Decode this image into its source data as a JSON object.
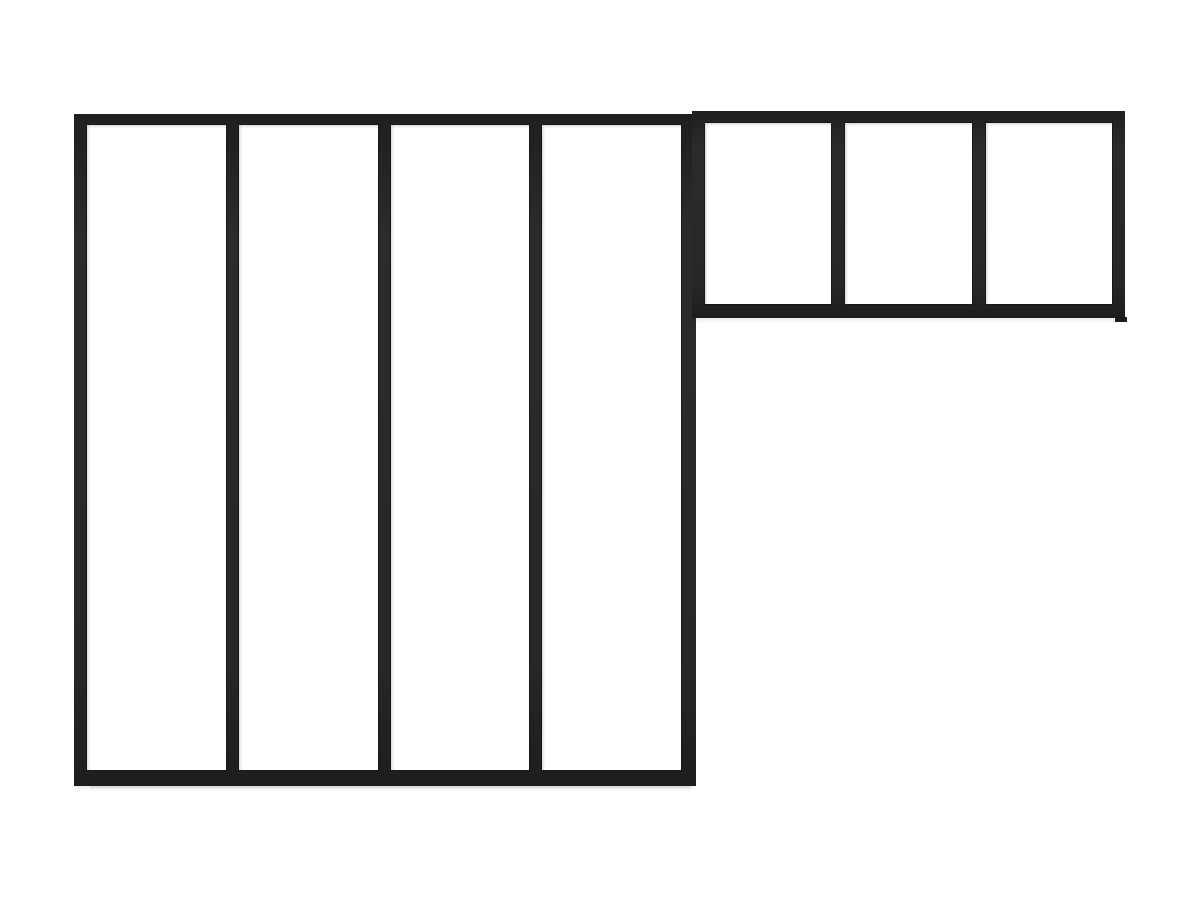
{
  "scene": {
    "title": "Black metal L-shaped atelier-style glazed partition frame on white background",
    "background_color": "#ffffff",
    "frame_color": "#272727",
    "frame_edge_color": "#181818",
    "shadow_color": "rgba(0,0,0,0.10)"
  },
  "partition": {
    "tall_section": {
      "label": "tall-left-section",
      "panels": 4
    },
    "short_section": {
      "label": "short-right-section",
      "panels": 3
    }
  }
}
